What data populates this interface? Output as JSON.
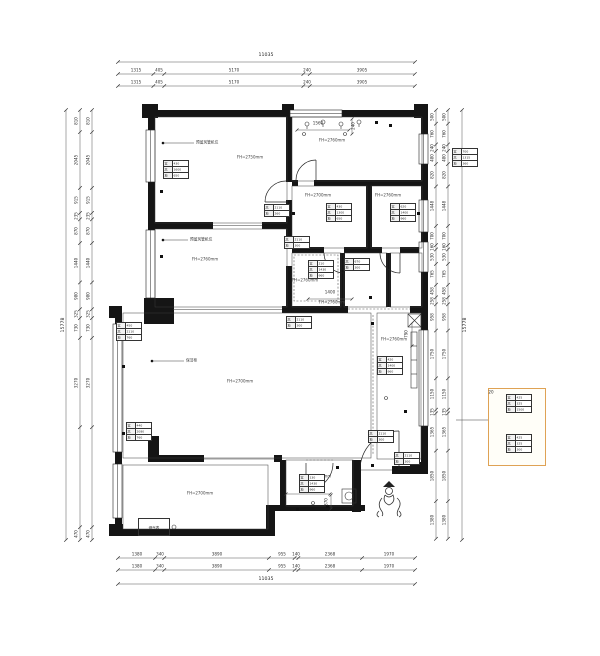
{
  "drawing": {
    "type": "residential-floor-plan",
    "units": "mm",
    "accent_color": "#dfa254",
    "dim_totals": {
      "top": "11035",
      "bottom": "11035",
      "left": "15778",
      "right": "15778"
    },
    "dim_chains": {
      "top_row1": [
        "1315",
        "405",
        "5170",
        "240",
        "3905"
      ],
      "top_row2": [
        "1315",
        "405",
        "5170",
        "240",
        "3905"
      ],
      "bottom_row1": [
        "1380",
        "340",
        "3890",
        "955",
        "140",
        "2368",
        "1970"
      ],
      "bottom_row2": [
        "1380",
        "340",
        "3890",
        "955",
        "140",
        "2368",
        "1970"
      ],
      "left_row": [
        "810",
        "2045",
        "915",
        "235",
        "870",
        "1440",
        "980",
        "325",
        "730",
        "3270",
        "470"
      ],
      "right_row": [
        "500",
        "760",
        "240",
        "480",
        "820",
        "1448",
        "700",
        "160",
        "530",
        "765",
        "458",
        "258",
        "958",
        "1750",
        "1150",
        "135",
        "1365",
        "1850",
        "1380"
      ]
    },
    "inline_dims": {
      "d1560": "1560",
      "d240": "240",
      "d1400": "1400",
      "d1140": "1140",
      "d370": "370",
      "d790": "790",
      "d20": "20"
    },
    "rooms": [
      {
        "label": "FH=2750mm"
      },
      {
        "label": "FH=2760mm"
      },
      {
        "label": "FH=2760mm"
      },
      {
        "label": "FH=2700mm"
      },
      {
        "label": "FH=2760mm"
      },
      {
        "label": "FH=2760mm"
      },
      {
        "label": "FH=2760mm"
      },
      {
        "label": "FH=2700mm"
      },
      {
        "label": "FH=2760mm"
      },
      {
        "label": "FH=2760mm"
      },
      {
        "label": "FH=2700mm"
      }
    ],
    "leader_notes": [
      "预留风管机位",
      "预留风管机位",
      "保洁柜"
    ],
    "meter_label": "燃气表",
    "annotation_tables": [
      {
        "rows": [
          [
            "宽",
            "430"
          ],
          [
            "高",
            "1600"
          ],
          [
            "地",
            "650"
          ]
        ]
      },
      {
        "rows": [
          [
            "宽",
            "700"
          ],
          [
            "高",
            "1315"
          ],
          [
            "地",
            "360"
          ]
        ]
      },
      {
        "rows": [
          [
            "高",
            "2110"
          ],
          [
            "地",
            "260"
          ]
        ]
      },
      {
        "rows": [
          [
            "宽",
            "430"
          ],
          [
            "高",
            "1300"
          ],
          [
            "地",
            "650"
          ]
        ]
      },
      {
        "rows": [
          [
            "宽",
            "620"
          ],
          [
            "高",
            "1400"
          ],
          [
            "地",
            "960"
          ]
        ]
      },
      {
        "rows": [
          [
            "高",
            "2110"
          ],
          [
            "地",
            "300"
          ]
        ]
      },
      {
        "rows": [
          [
            "宽",
            "210"
          ],
          [
            "高",
            "1430"
          ],
          [
            "地",
            "960"
          ]
        ]
      },
      {
        "rows": [
          [
            "高",
            "670"
          ],
          [
            "地",
            "300"
          ]
        ]
      },
      {
        "rows": [
          [
            "宽",
            "450"
          ],
          [
            "高",
            "2110"
          ],
          [
            "地",
            "760"
          ]
        ]
      },
      {
        "rows": [
          [
            "宽",
            "440"
          ],
          [
            "高",
            "2080"
          ],
          [
            "地",
            "760"
          ]
        ]
      },
      {
        "rows": [
          [
            "高",
            "2110"
          ],
          [
            "地",
            "300"
          ]
        ]
      },
      {
        "rows": [
          [
            "宽",
            "420"
          ],
          [
            "高",
            "1400"
          ],
          [
            "地",
            "960"
          ]
        ]
      },
      {
        "rows": [
          [
            "高",
            "2110"
          ],
          [
            "地",
            "300"
          ]
        ]
      },
      {
        "rows": [
          [
            "宽",
            "130"
          ],
          [
            "高",
            "1430"
          ],
          [
            "地",
            "960"
          ]
        ]
      },
      {
        "rows": [
          [
            "高",
            "2110"
          ],
          [
            "地",
            "300"
          ]
        ]
      },
      {
        "rows": [
          [
            "宽",
            "425"
          ],
          [
            "高",
            "325"
          ],
          [
            "地",
            "1500"
          ]
        ]
      },
      {
        "rows": [
          [
            "宽",
            "425"
          ],
          [
            "高",
            "325"
          ],
          [
            "地",
            "300"
          ]
        ]
      }
    ]
  }
}
